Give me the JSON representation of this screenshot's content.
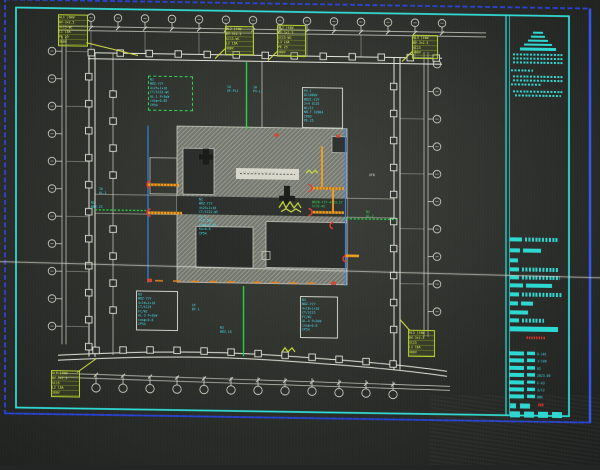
{
  "colors": {
    "frame_blue": "#2a46e0",
    "frame_cyan": "#2de2dc",
    "annotation_cyan": "#41d9ec",
    "highlight_green": "#22d14a",
    "device_yellow": "#dce84a",
    "tray_orange": "#f59a18",
    "alert_red": "#e03428",
    "dim_white": "#d6d7cc",
    "hatch_gray": "#a2a49a",
    "paper_dark": "#2b2e2a"
  },
  "plan": {
    "center_label": "· ·· · ··· · ·· · ·",
    "annotations": {
      "green_box": {
        "lines": [
          "N1",
          "WDZ-YJY",
          "4×25+1×16",
          "CT/SC32-WC",
          "AL-1 P=3kW",
          "cosφ=0.85",
          "IP54"
        ]
      },
      "top_box": {
        "lines": [
          "PV-1",
          "DC1000V",
          "WDZC-YJY",
          "2×4 SC25",
          "WC/CC",
          "NB-T 32004",
          "IP65",
          "PE-25"
        ]
      },
      "bottom_left_box": {
        "lines": [
          "N3",
          "WDZ-YJY",
          "4×16+1×10",
          "CT/SC25",
          "FC/WC",
          "AL-3 P=2kW",
          "cosφ=0.8",
          "IP54"
        ]
      },
      "bottom_right_box": {
        "lines": [
          "N4",
          "WDZ-YJY",
          "4×16+1×10",
          "CT/SC25",
          "FC/WC",
          "AL-4 P=2kW",
          "cosφ=0.8",
          "IP54"
        ]
      },
      "center_note": {
        "lines": [
          "N2",
          "WDZ-YJY",
          "4×25+1×16",
          "CT/SC32-WC",
          "AL-2",
          "P=2.5kW",
          "cosφ=0.85",
          "Kx=0.8",
          "IP54"
        ]
      },
      "labels": [
        {
          "id": "f1",
          "lines": [
            "1A",
            "XF-PL1"
          ]
        },
        {
          "id": "f2",
          "lines": [
            "1A",
            "PV-L1"
          ]
        },
        {
          "id": "f3",
          "lines": [
            "1A",
            "AL-1"
          ]
        },
        {
          "id": "f4",
          "lines": [
            "N1",
            "WDZ-25"
          ]
        },
        {
          "id": "f5",
          "lines": [
            "WDZN-YJY-4×25-CT",
            "SC32-WC"
          ]
        },
        {
          "id": "f6",
          "lines": [
            "N2",
            "AL-2"
          ]
        },
        {
          "id": "f7",
          "lines": [
            "N3",
            "WDZ-16"
          ]
        },
        {
          "id": "f8",
          "lines": [
            "XF",
            "BF-1"
          ]
        },
        {
          "id": "f9",
          "lines": [
            "XFB"
          ]
        }
      ]
    },
    "device_tables": {
      "t1": {
        "rows": [
          "AL1 │6kW",
          "BV-3×2.5",
          "SC15-WC",
          "L1 16A",
          "PE 25",
          "380V"
        ]
      },
      "t2": {
        "rows": [
          "AL2 │4kW",
          "BV-3×2.5",
          "SC15-WC",
          "L2 16A",
          "380V"
        ]
      },
      "t3": {
        "rows": [
          "AL3 │4kW",
          "BV-3×2.5",
          "SC15-WC",
          "L3 16A",
          "PE 25",
          "380V"
        ]
      },
      "t4": {
        "rows": [
          "AL4 │4kW",
          "BV-3×2.5",
          "SC15",
          "380V"
        ]
      },
      "t5": {
        "rows": [
          "AL5 │4kW",
          "BV-3×2.5",
          "SC15",
          "L1 16A",
          "380V"
        ]
      },
      "t6": {
        "rows": [
          "AL6 │4kW",
          "BV-3×2.5",
          "SC15",
          "L2 16A",
          "380V"
        ]
      }
    }
  },
  "title_block": {
    "red_banner": "▮▮▮▮▮▮▮▮",
    "red_cell": "▮▮▮",
    "values": [
      "G-101",
      "1:100",
      "A2",
      "2023.06",
      "E-03",
      "3/12",
      "DWG"
    ]
  }
}
